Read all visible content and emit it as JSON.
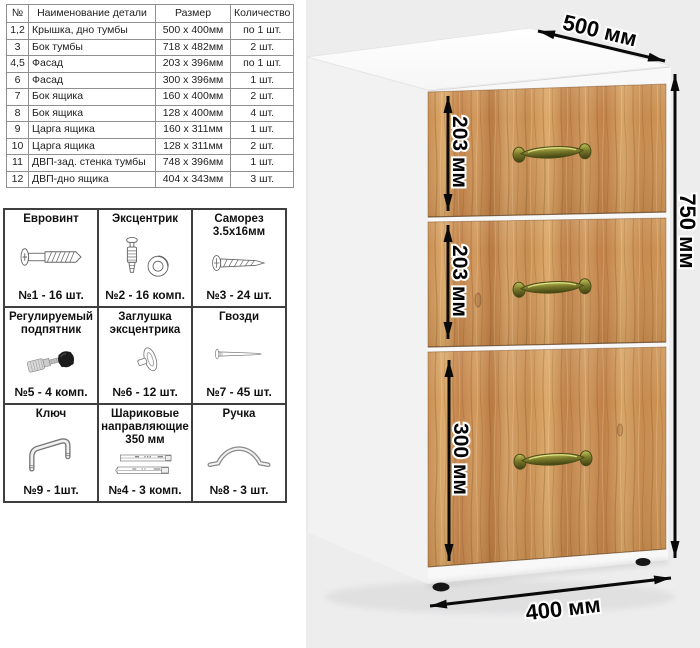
{
  "parts_table": {
    "headers": [
      "№",
      "Наименование детали",
      "Размер",
      "Количество"
    ],
    "rows": [
      {
        "num": "1,2",
        "name": "Крышка, дно тумбы",
        "size": "500 x 400мм",
        "qty": "по 1 шт."
      },
      {
        "num": "3",
        "name": "Бок тумбы",
        "size": "718 x 482мм",
        "qty": "2 шт."
      },
      {
        "num": "4,5",
        "name": "Фасад",
        "size": "203 x 396мм",
        "qty": "по 1 шт."
      },
      {
        "num": "6",
        "name": "Фасад",
        "size": "300 x 396мм",
        "qty": "1 шт."
      },
      {
        "num": "7",
        "name": "Бок ящика",
        "size": "160 x 400мм",
        "qty": "2 шт."
      },
      {
        "num": "8",
        "name": "Бок ящика",
        "size": "128 x 400мм",
        "qty": "4 шт."
      },
      {
        "num": "9",
        "name": "Царга ящика",
        "size": "160 x 311мм",
        "qty": "1 шт."
      },
      {
        "num": "10",
        "name": "Царга ящика",
        "size": "128 x 311мм",
        "qty": "2 шт."
      },
      {
        "num": "11",
        "name": "ДВП-зад. стенка тумбы",
        "size": "748 x 396мм",
        "qty": "1 шт."
      },
      {
        "num": "12",
        "name": "ДВП-дно ящика",
        "size": "404 x 343мм",
        "qty": "3 шт."
      }
    ]
  },
  "hardware": {
    "cells": [
      {
        "title": "Евровинт",
        "count": "№1 - 16 шт.",
        "icon": "euro-screw-icon"
      },
      {
        "title": "Эксцентрик",
        "count": "№2 - 16 комп.",
        "icon": "eccentric-cam-icon"
      },
      {
        "title": "Саморез 3.5х16мм",
        "count": "№3 - 24 шт.",
        "icon": "self-tapping-screw-icon"
      },
      {
        "title": "Регулируемый подпятник",
        "count": "№5 - 4 комп.",
        "icon": "adjustable-foot-icon"
      },
      {
        "title": "Заглушка эксцентрика",
        "count": "№6 - 12 шт.",
        "icon": "cam-cap-icon"
      },
      {
        "title": "Гвозди",
        "count": "№7 - 45 шт.",
        "icon": "nail-icon"
      },
      {
        "title": "Ключ",
        "count": "№9 - 1шт.",
        "icon": "hex-key-icon"
      },
      {
        "title": "Шариковые направляющие 350 мм",
        "count": "№4 - 3 комп.",
        "icon": "ball-slides-icon"
      },
      {
        "title": "Ручка",
        "count": "№8 - 3 шт.",
        "icon": "handle-icon"
      }
    ]
  },
  "cabinet": {
    "dim_top": "500 мм",
    "dim_right": "750 мм",
    "dim_bottom": "400 мм",
    "drawer_dims": [
      "203 мм",
      "203 мм",
      "300 мм"
    ]
  },
  "colors": {
    "backdrop": "#ededee",
    "wood_mid": "#c98e52",
    "handle_bronze": "#8f8f2f",
    "arrow": "#0a0a0a"
  }
}
